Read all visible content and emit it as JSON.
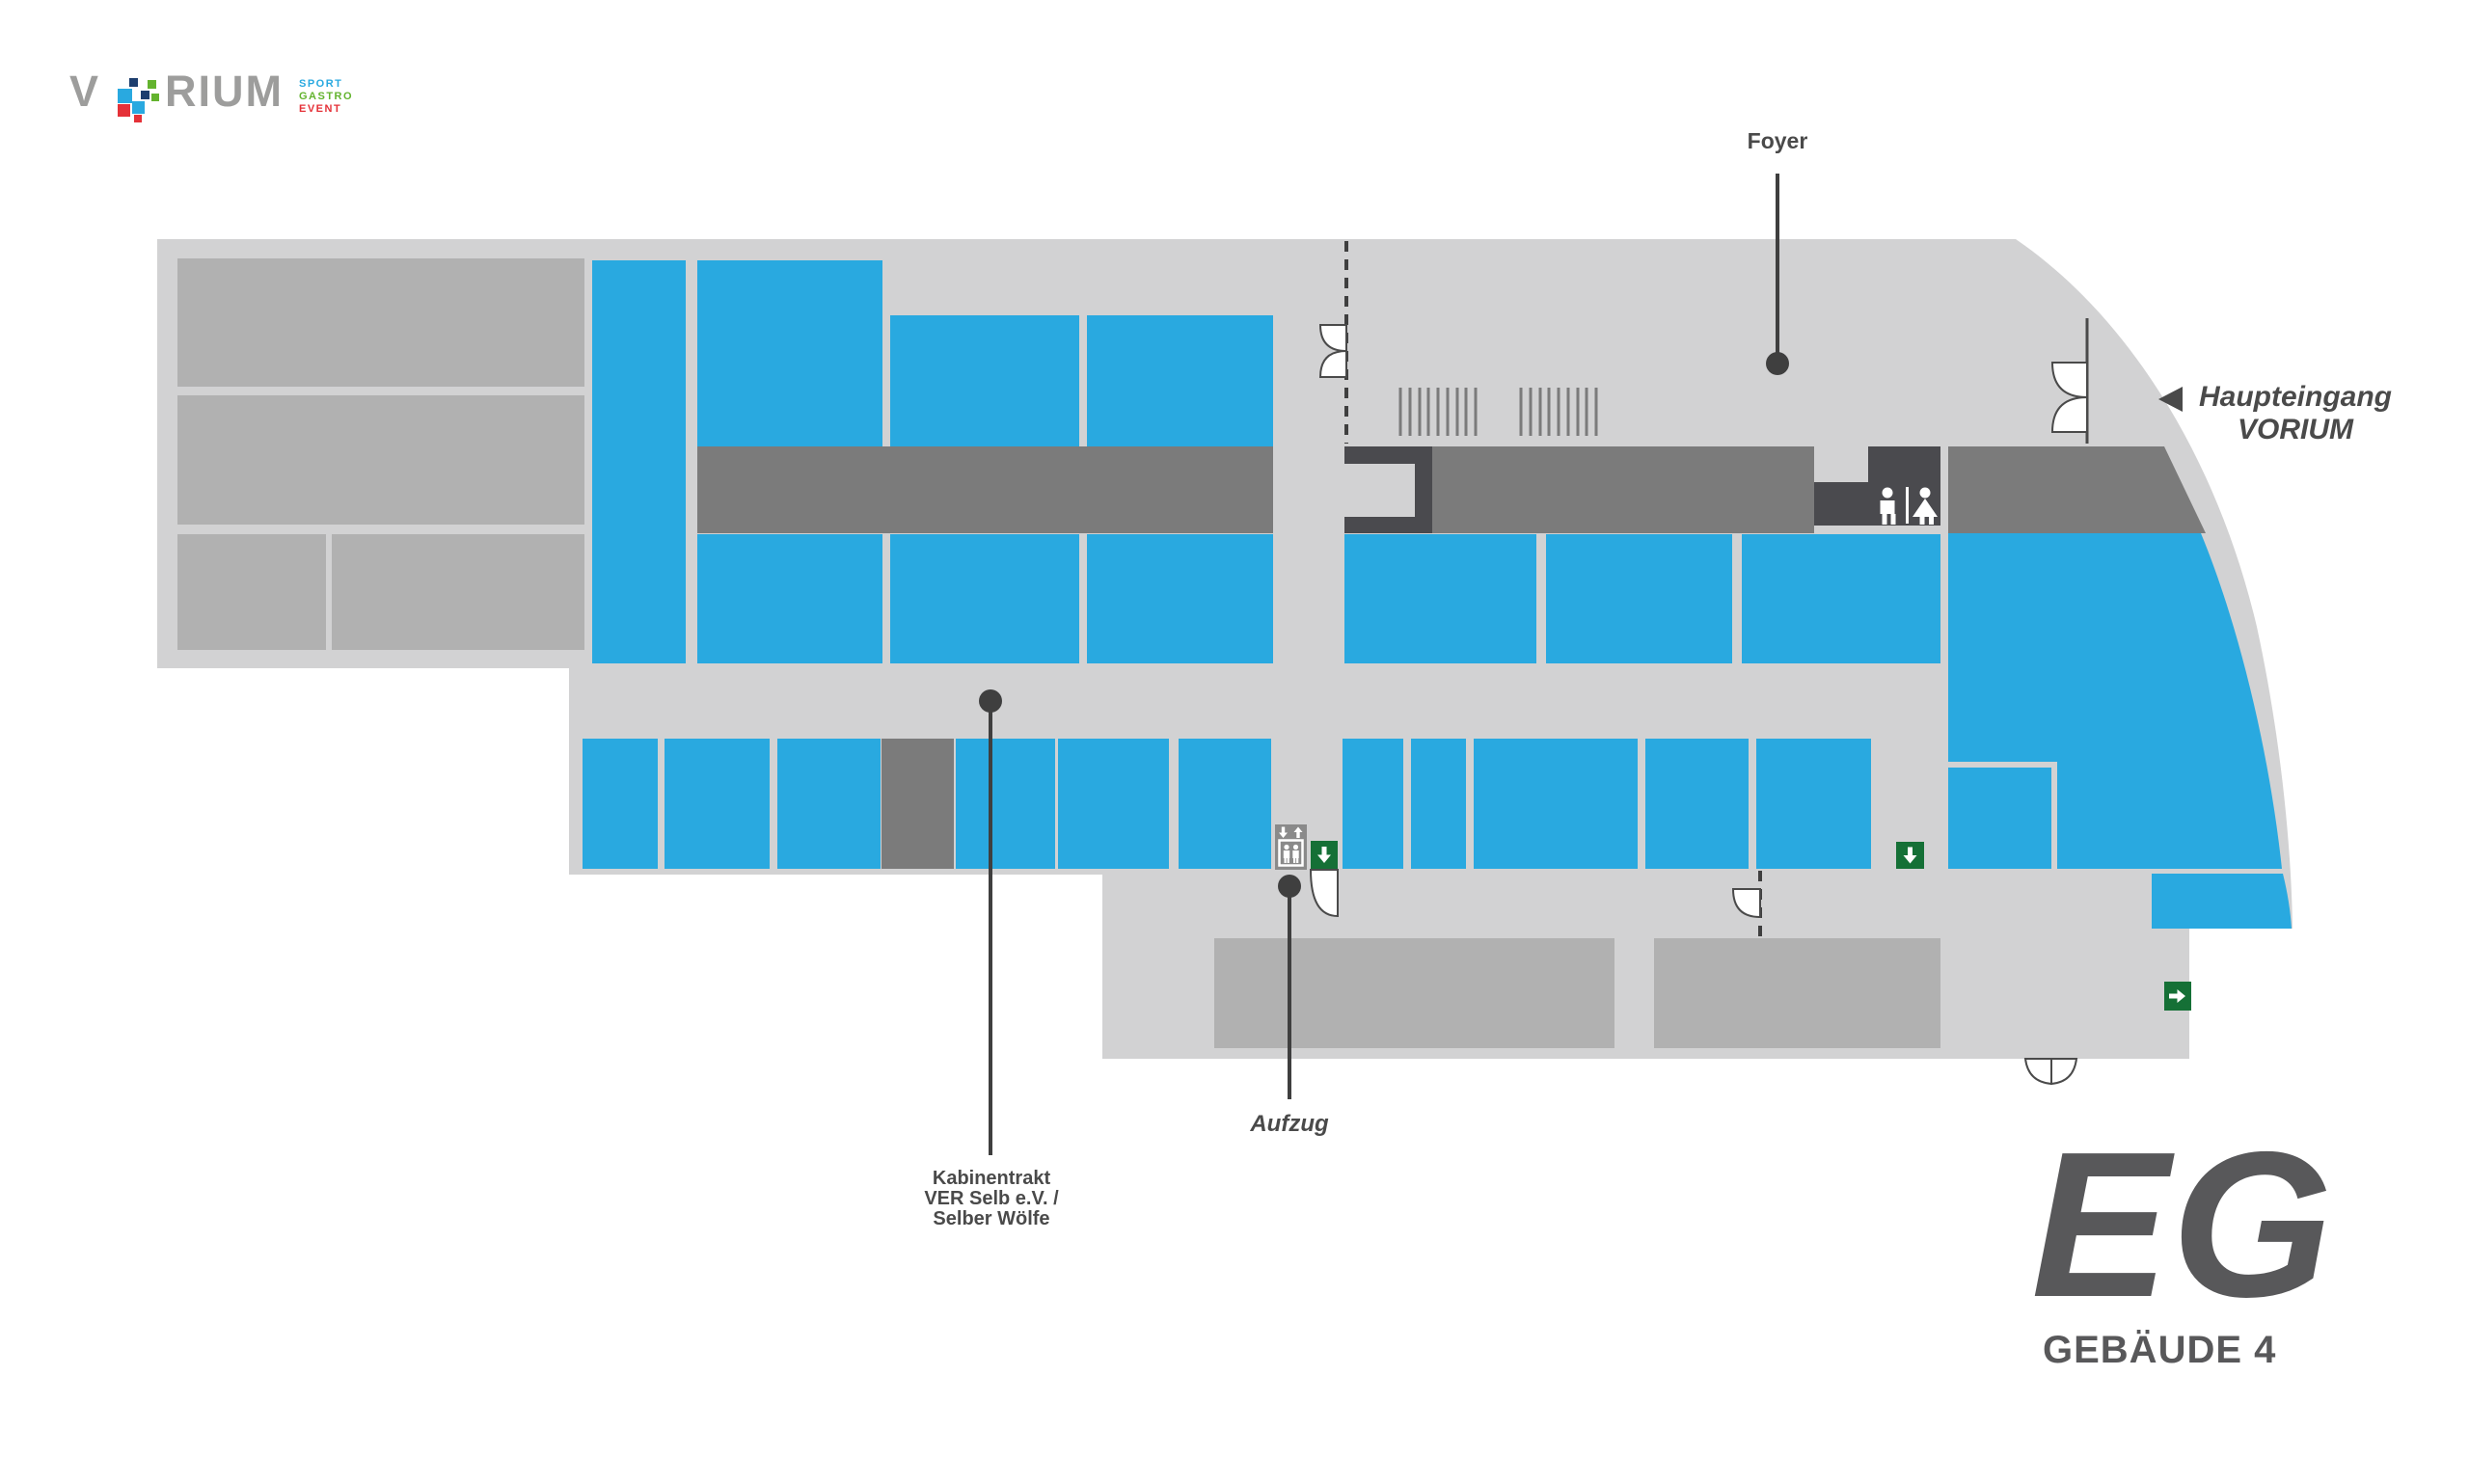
{
  "logo": {
    "prefix": "V",
    "suffix": "RIUM",
    "tagline": {
      "sport": "SPORT",
      "gastro": "GASTRO",
      "event": "EVENT"
    }
  },
  "callouts": {
    "foyer": {
      "label": "Foyer"
    },
    "aufzug": {
      "label": "Aufzug"
    },
    "kabinentrakt": {
      "line1": "Kabinentrakt",
      "line2": "VER Selb e.V. /",
      "line3": "Selber Wölfe"
    }
  },
  "entrance": {
    "line1": "Haupteingang",
    "line2": "VORIUM"
  },
  "floor": {
    "level": "EG",
    "building": "GEBÄUDE 4"
  },
  "icons": [
    "wc-man-icon",
    "wc-woman-icon",
    "elevator-icon",
    "exit-down-arrow-sign",
    "exit-right-arrow-sign",
    "main-entrance-arrow-icon"
  ],
  "palette": {
    "room_blue": "#29A9E0",
    "floor_gray": "#D2D2D3",
    "block_gray": "#B1B1B1",
    "corridor_gray": "#7B7B7B",
    "dark_gray": "#4A4A4E",
    "sign_green": "#157036",
    "elevator_gray": "#8A8A8A",
    "text_gray": "#4A4A4A",
    "title_gray": "#58585A",
    "logo_gray": "#9D9D9C",
    "logo_navy": "#1D3E6E",
    "logo_red": "#E53138",
    "logo_green": "#63B32E"
  }
}
